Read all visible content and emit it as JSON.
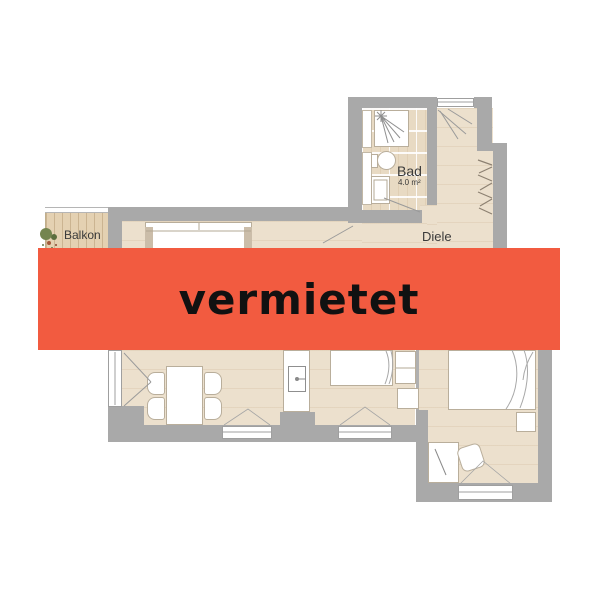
{
  "banner": {
    "label": "vermietet",
    "background_color": "#f25b40",
    "text_color": "#111111"
  },
  "floorplan": {
    "labels": {
      "balcony": "Balkon",
      "bath": "Bad",
      "bath_area": "4.0 m²",
      "hallway": "Diele"
    },
    "colors": {
      "wall": "#a9a9a9",
      "wood_floor": "#ece0cd",
      "tile_floor": "#e8dac3",
      "balcony_deck": "#e4d1b2",
      "furniture_outline": "#b9ae9b"
    },
    "icons": {
      "plant-icon": "green/red foliage blob cluster (css circles)",
      "shower-icon": "square tray with spray lines (svg)",
      "toilet-icon": "ellipse bowl with tank (css)",
      "washbasin-icon": "rectangle basin (css+svg)",
      "kitchen-sink-icon": "rectangle with faucet dot+line (svg)",
      "coat-hooks-icon": "zigzag hanger strokes (svg)",
      "door-swing-icon": "diagonal swing lines (svg)"
    }
  }
}
